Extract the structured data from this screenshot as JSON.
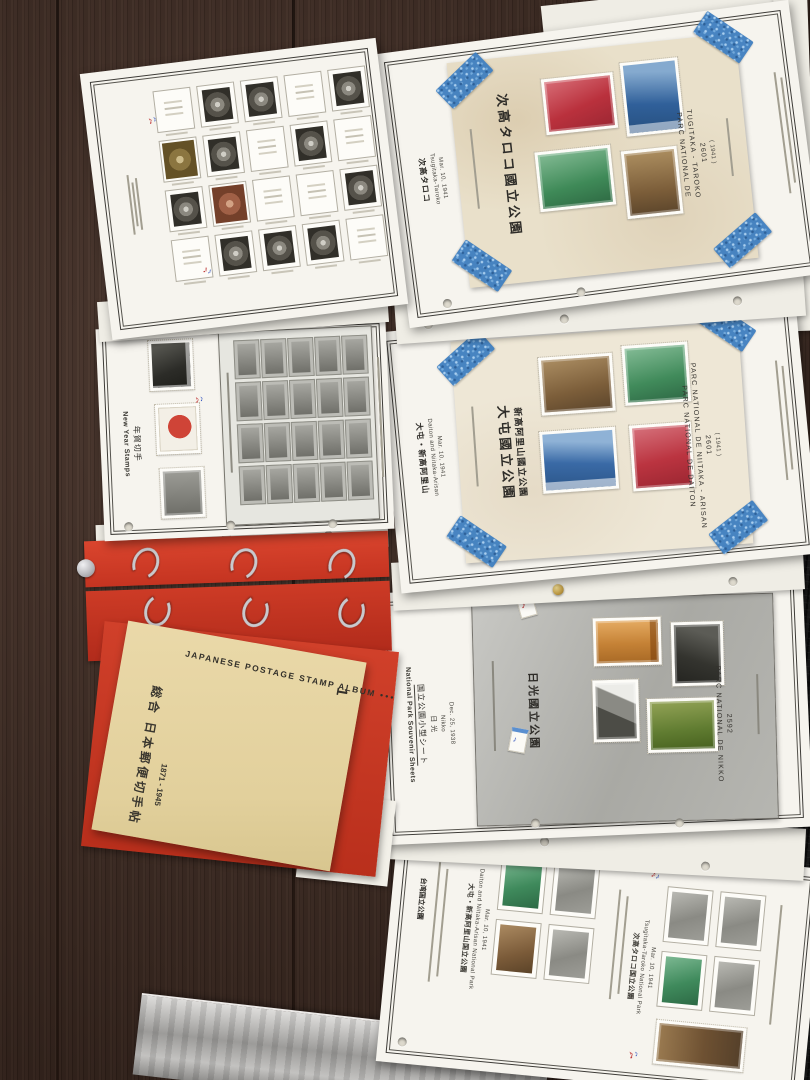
{
  "colors": {
    "tape_blue": "#3f7fc0",
    "binder_red": "#cd3b26",
    "cover_manila": "#ead9a9",
    "wood_brown": "#422e25",
    "fabric_black": "#141414"
  },
  "annotations": {
    "glyph": "♪"
  },
  "cover": {
    "title_jp": "総合 日本郵便切手帖",
    "years": "1871 - 1945",
    "title_en": "JAPANESE POSTAGE STAMP ALBUM",
    "dots": "• • •",
    "volume": "1"
  },
  "pages": {
    "l1": {
      "cells": [
        "blank",
        "printed",
        "printed",
        "blank",
        "printed",
        "olive",
        "printed",
        "blank",
        "printed",
        "blank",
        "printed",
        "rust",
        "blank",
        "blank",
        "printed",
        "blank",
        "printed",
        "printed",
        "printed",
        "blank"
      ]
    },
    "l2": {
      "header_en": "New Year Stamps",
      "header_jp": "年賀切手",
      "sheet_cells": [
        "g",
        "g",
        "g",
        "g",
        "g",
        "g",
        "g",
        "g",
        "g",
        "g",
        "g",
        "g",
        "g",
        "g",
        "g",
        "g",
        "g",
        "g",
        "g",
        "g"
      ]
    },
    "r1": {
      "header_jp": "次高タロコ",
      "header_en": "Tsugitaka-Taroko",
      "date": "Mar. 10, 1941",
      "sheet": {
        "title_jp": "次高タロコ國立公園",
        "fr1": "PARC NATIONAL DE",
        "fr2": "TUGITAKA - TAROKO",
        "year": "2601",
        "year_paren": "( 1941 )"
      }
    },
    "r2": {
      "header_jp": "大屯・新高阿里山",
      "header_en": "Daiton and Niitaka-Arisan",
      "date": "Mar. 10, 1941",
      "sheet": {
        "title_jp1": "大屯國立公園",
        "title_jp2": "新高阿里山國立公園",
        "fr1": "PARC NATIONAL DE DAITON",
        "fr2": "PARC NATIONAL DE NIITAKA - ARISAN",
        "year": "2601",
        "year_paren": "( 1941 )"
      }
    },
    "r3": {
      "header_en": "National Park Souvenir Sheets",
      "header_jp": "国立公園小型シート",
      "place_jp": "日 光",
      "place_en": "Nikko",
      "date": "Dec. 25, 1938",
      "sheet": {
        "title_jp": "日光國立公園",
        "fr1": "PARC NATIONAL DE NIKKO",
        "year": "2592"
      }
    },
    "r4": {
      "section_jp": "台湾国立公園",
      "group1": {
        "title_jp": "大屯・新高阿里山国立公園",
        "title_en": "Daiton and Niitaka-Arisan National Park",
        "date": "Mar. 10, 1941",
        "cells": [
          "green",
          "printed",
          "brown",
          "printed"
        ]
      },
      "group2": {
        "title_jp": "次高タロコ国立公園",
        "title_en": "Tsugitaka-Taroko National Park",
        "date": "Mar. 10, 1941",
        "cells": [
          "printed",
          "printed",
          "green",
          "printed"
        ]
      }
    }
  }
}
